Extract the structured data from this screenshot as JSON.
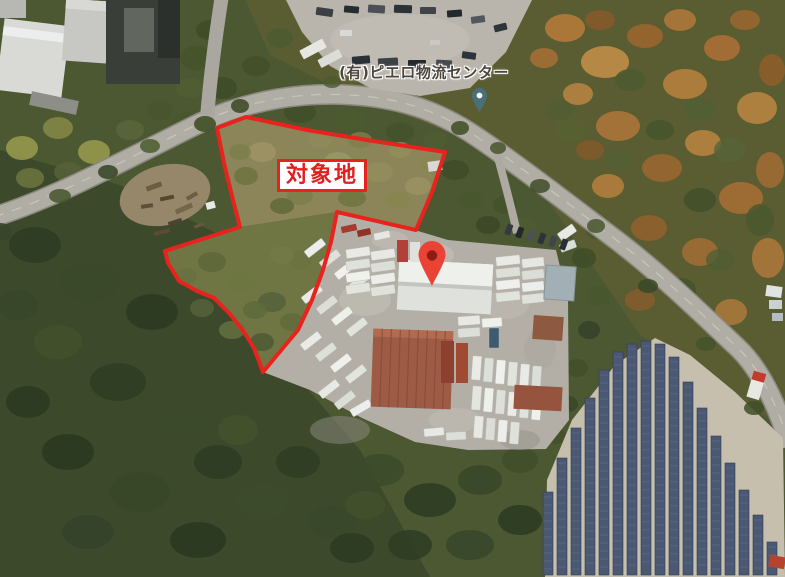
{
  "map": {
    "site_label": {
      "text": "対象地",
      "x": 277,
      "y": 159,
      "color": "#e01f1f",
      "bg": "#ffffff",
      "border_color": "#e8231d"
    },
    "site_outline": {
      "color": "#e8231d",
      "stroke_width": 4,
      "points": [
        [
          217,
          128
        ],
        [
          246,
          117
        ],
        [
          307,
          130
        ],
        [
          373,
          141
        ],
        [
          445,
          152
        ],
        [
          432,
          192
        ],
        [
          416,
          230
        ],
        [
          337,
          212
        ],
        [
          331,
          242
        ],
        [
          323,
          270
        ],
        [
          312,
          300
        ],
        [
          298,
          330
        ],
        [
          263,
          372
        ],
        [
          254,
          348
        ],
        [
          244,
          332
        ],
        [
          230,
          314
        ],
        [
          214,
          298
        ],
        [
          197,
          291
        ],
        [
          179,
          281
        ],
        [
          168,
          263
        ],
        [
          165,
          251
        ],
        [
          240,
          227
        ],
        [
          233,
          200
        ],
        [
          224,
          163
        ]
      ]
    },
    "poi": {
      "label": "(有)ピエロ物流センター",
      "x": 424,
      "y": 72,
      "color": "#4e463d",
      "pin": {
        "x": 479.5,
        "y": 95.5,
        "r": 7.6,
        "tip_y": 112.5,
        "color": "#4a7077",
        "dot_color": "#ffffff"
      }
    },
    "red_marker": {
      "x": 432,
      "y": 254.5,
      "r": 13.5,
      "tip_y": 286,
      "color": "#ea4335",
      "dot_color": "#8c1d12"
    }
  }
}
